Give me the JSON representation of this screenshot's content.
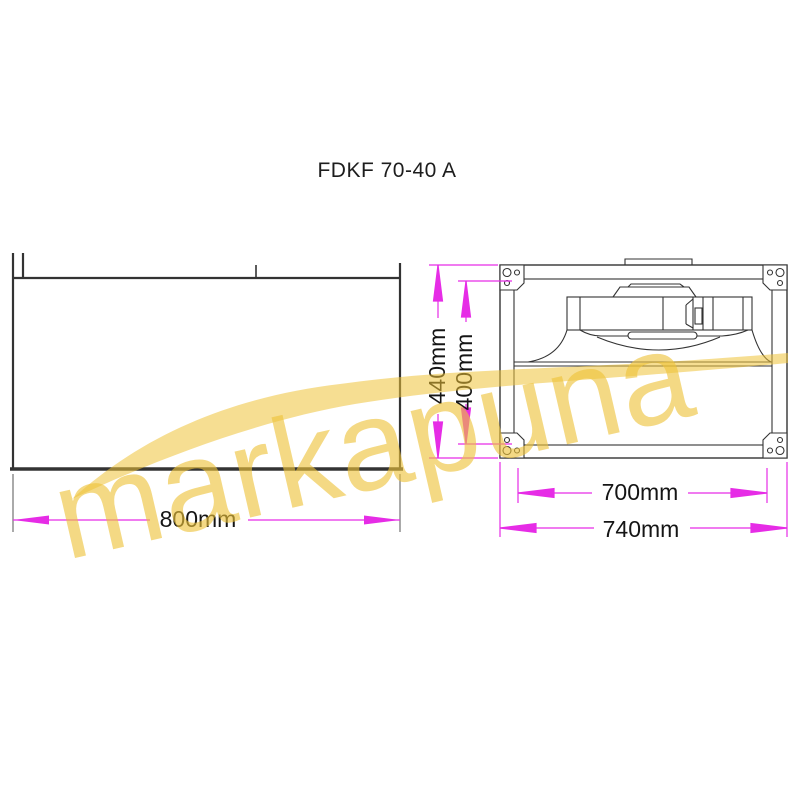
{
  "title": "FDKF 70-40 A",
  "watermark": {
    "text": "markapuna",
    "color": "#eec339"
  },
  "colors": {
    "background": "#ffffff",
    "object_line": "#333333",
    "dimension_accent": "#e62ce6",
    "label_text": "#151515",
    "watermark_yellow": "#eec339"
  },
  "views": {
    "side_view": {
      "name": "duct side view",
      "dimensions": {
        "length": "800mm"
      }
    },
    "front_view": {
      "name": "fan front view with impeller",
      "dimensions": {
        "outer_height": "440mm",
        "inner_height": "400mm",
        "inner_width": "700mm",
        "outer_width": "740mm"
      }
    }
  }
}
